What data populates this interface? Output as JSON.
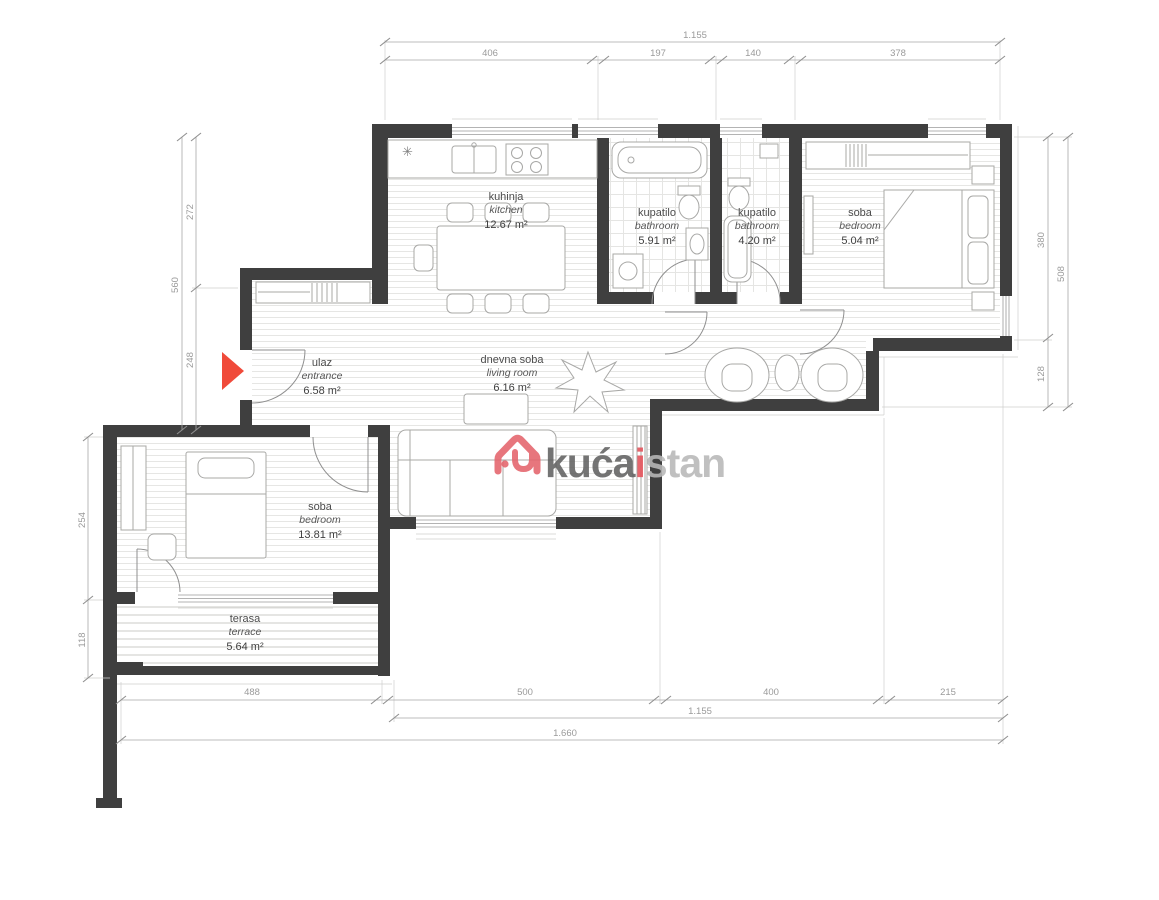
{
  "watermark": {
    "brand_part1": "kuća",
    "brand_part2": "i",
    "brand_part3": "stan",
    "icon": "house-logo-icon",
    "color_primary": "#e4646c",
    "color_dark": "#616161",
    "color_light": "#b8b8b8"
  },
  "symbols": {
    "kitchen_vent": "✳"
  },
  "entrance_marker": {
    "icon": "entrance-arrow-icon",
    "color": "#f04a3a"
  },
  "rooms": {
    "kitchen": {
      "name": "kuhinja",
      "name_en": "kitchen",
      "area": "12.67 m²"
    },
    "bathroom1": {
      "name": "kupatilo",
      "name_en": "bathroom",
      "area": "5.91 m²"
    },
    "bathroom2": {
      "name": "kupatilo",
      "name_en": "bathroom",
      "area": "4.20 m²"
    },
    "bedroom_right": {
      "name": "soba",
      "name_en": "bedroom",
      "area": "5.04 m²"
    },
    "living_room": {
      "name": "dnevna soba",
      "name_en": "living room",
      "area": "6.16 m²"
    },
    "entrance": {
      "name": "ulaz",
      "name_en": "entrance",
      "area": "6.58 m²"
    },
    "bedroom_left": {
      "name": "soba",
      "name_en": "bedroom",
      "area": "13.81 m²"
    },
    "terrace": {
      "name": "terasa",
      "name_en": "terrace",
      "area": "5.64 m²"
    }
  },
  "dimensions": {
    "top": {
      "total": "1.155",
      "segments": [
        "406",
        "197",
        "140",
        "378"
      ]
    },
    "bottom": {
      "segments": [
        "488",
        "500",
        "400",
        "215"
      ],
      "subtotal": "1.155",
      "total": "1.660"
    },
    "left_upper": {
      "total": "560",
      "segments": [
        "272",
        "248"
      ]
    },
    "left_lower": {
      "segments": [
        "254",
        "118"
      ]
    },
    "right": {
      "total": "508",
      "segments": [
        "380",
        "128"
      ]
    }
  }
}
